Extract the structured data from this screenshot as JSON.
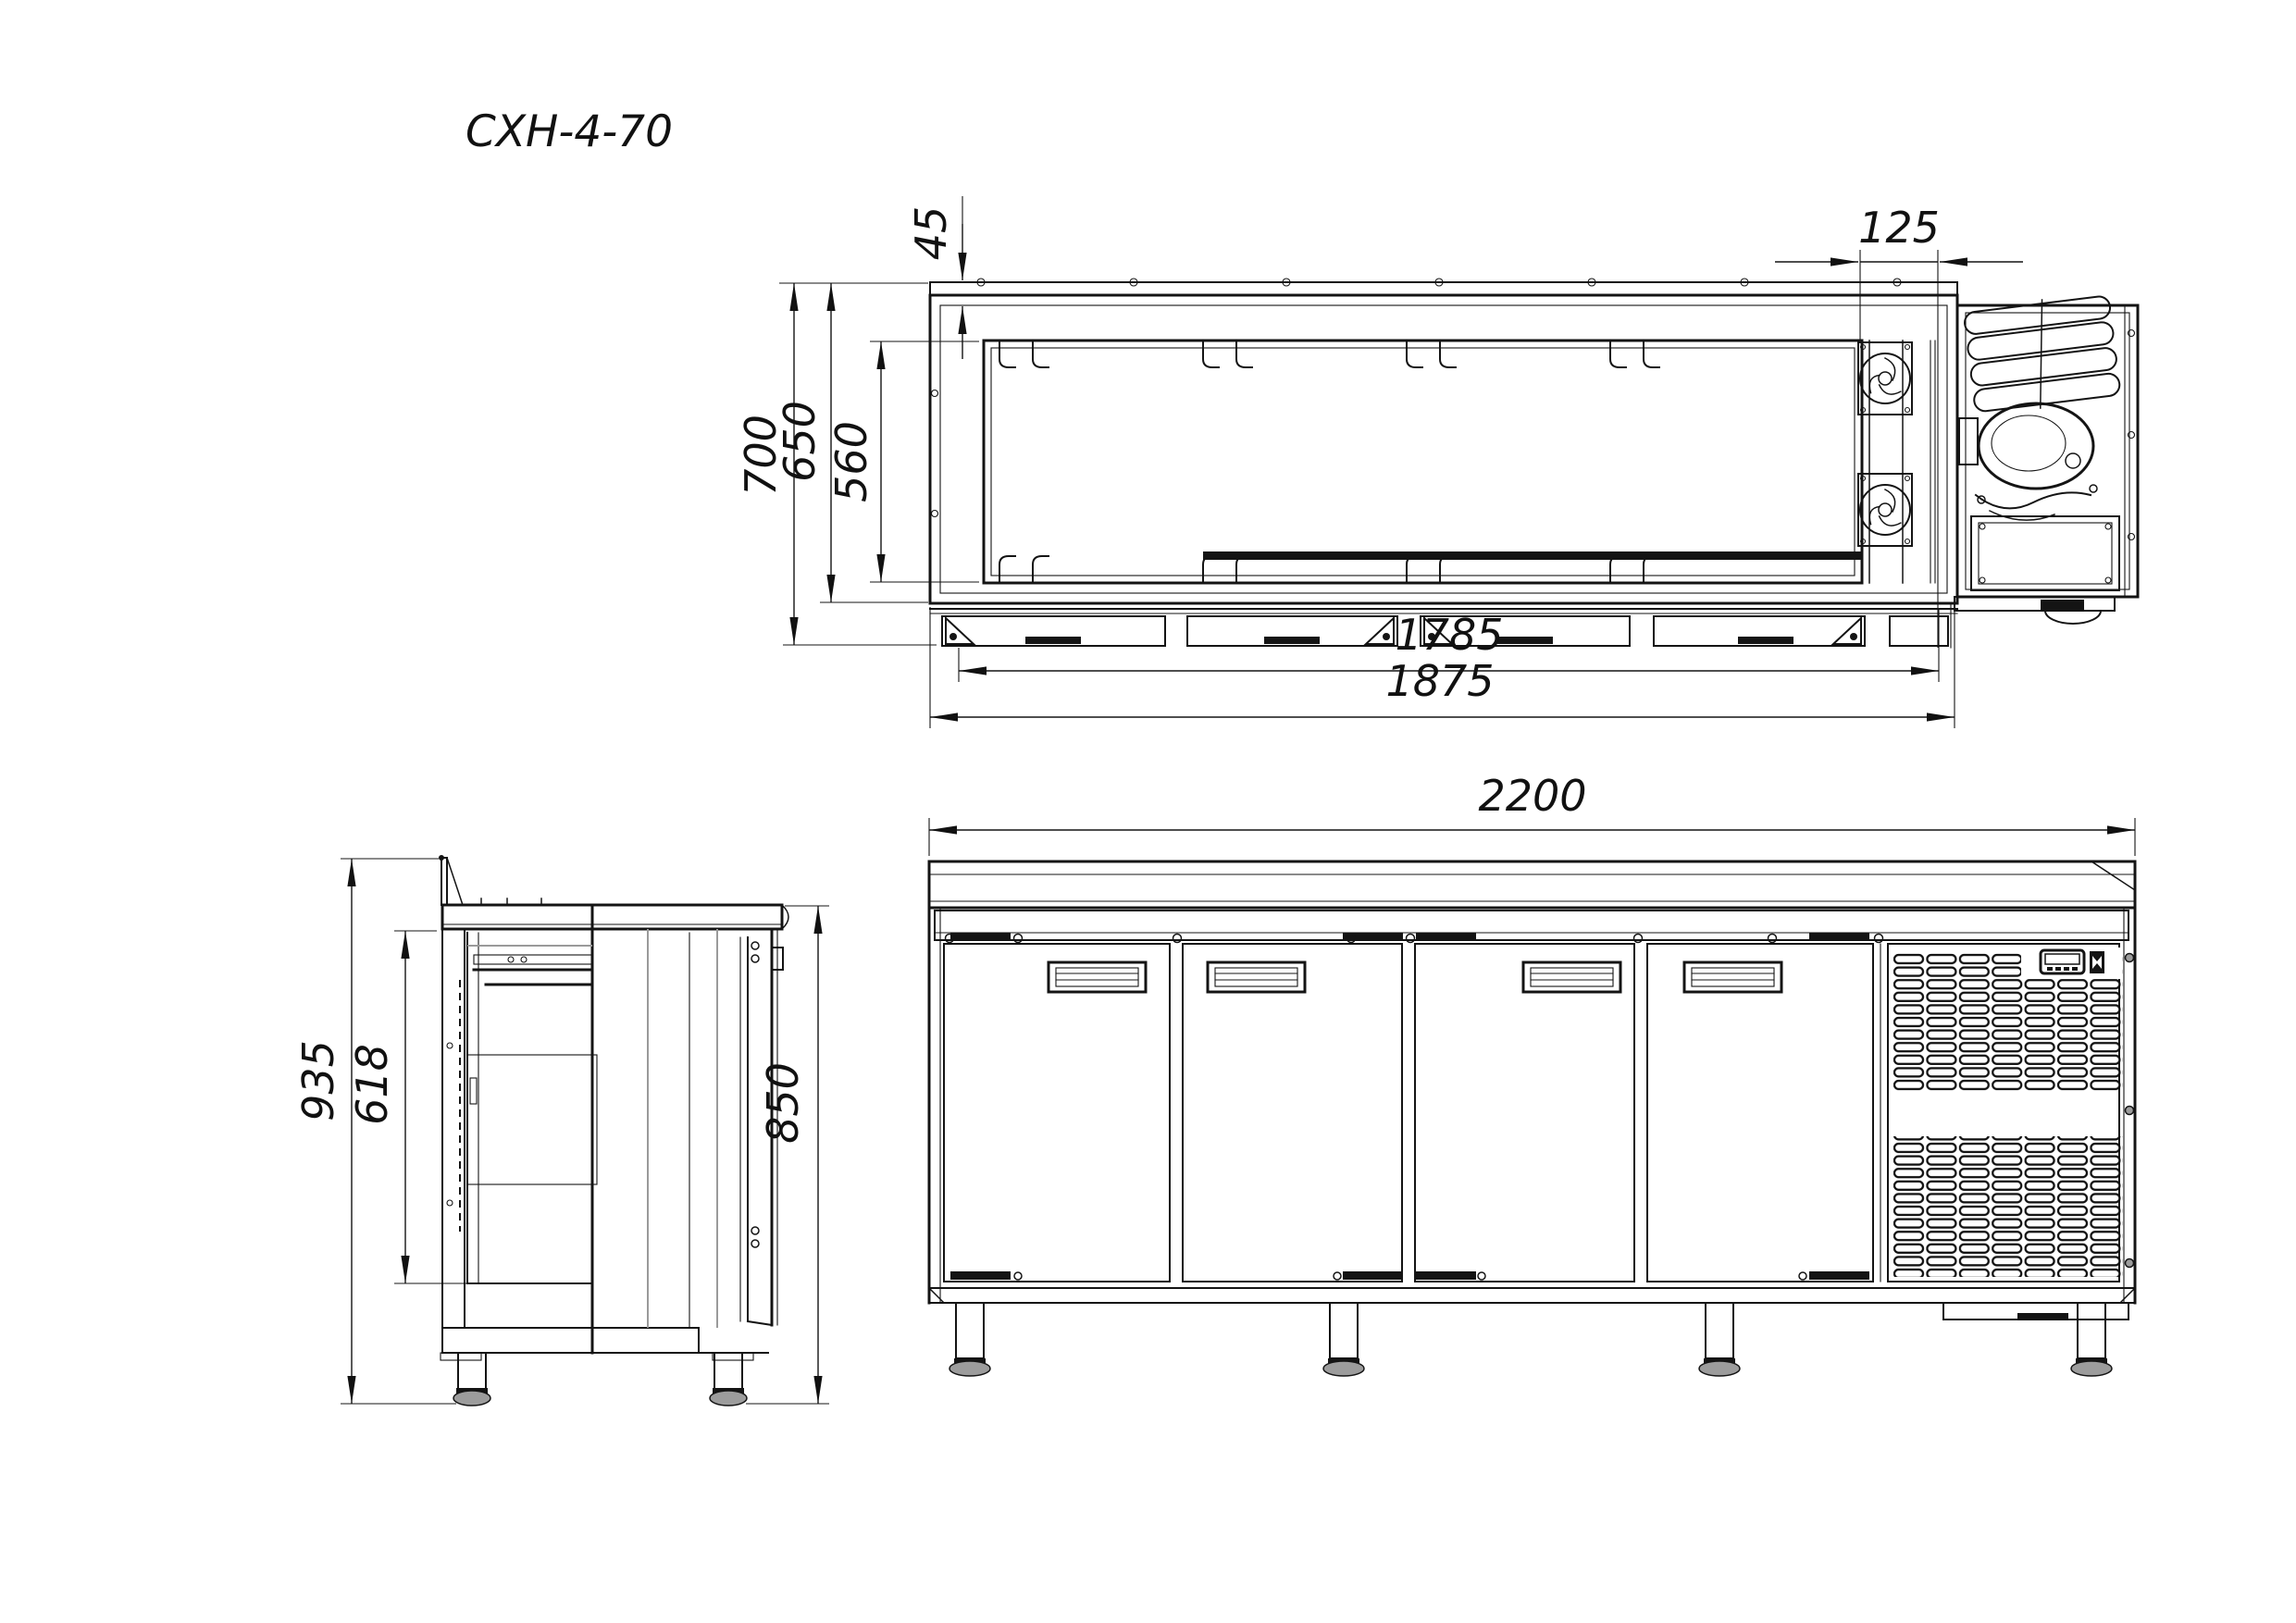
{
  "title": "СХН-4-70",
  "dimensions": {
    "plan_top_wall": "45",
    "plan_fan_section_width": "125",
    "plan_overall_depth": "700",
    "plan_body_depth": "650",
    "plan_interior_depth": "560",
    "plan_interior_width": "1785",
    "plan_body_width": "1875",
    "front_overall_width": "2200",
    "front_worktop_height": "850",
    "side_overall_height": "935",
    "side_interior_height": "618"
  }
}
